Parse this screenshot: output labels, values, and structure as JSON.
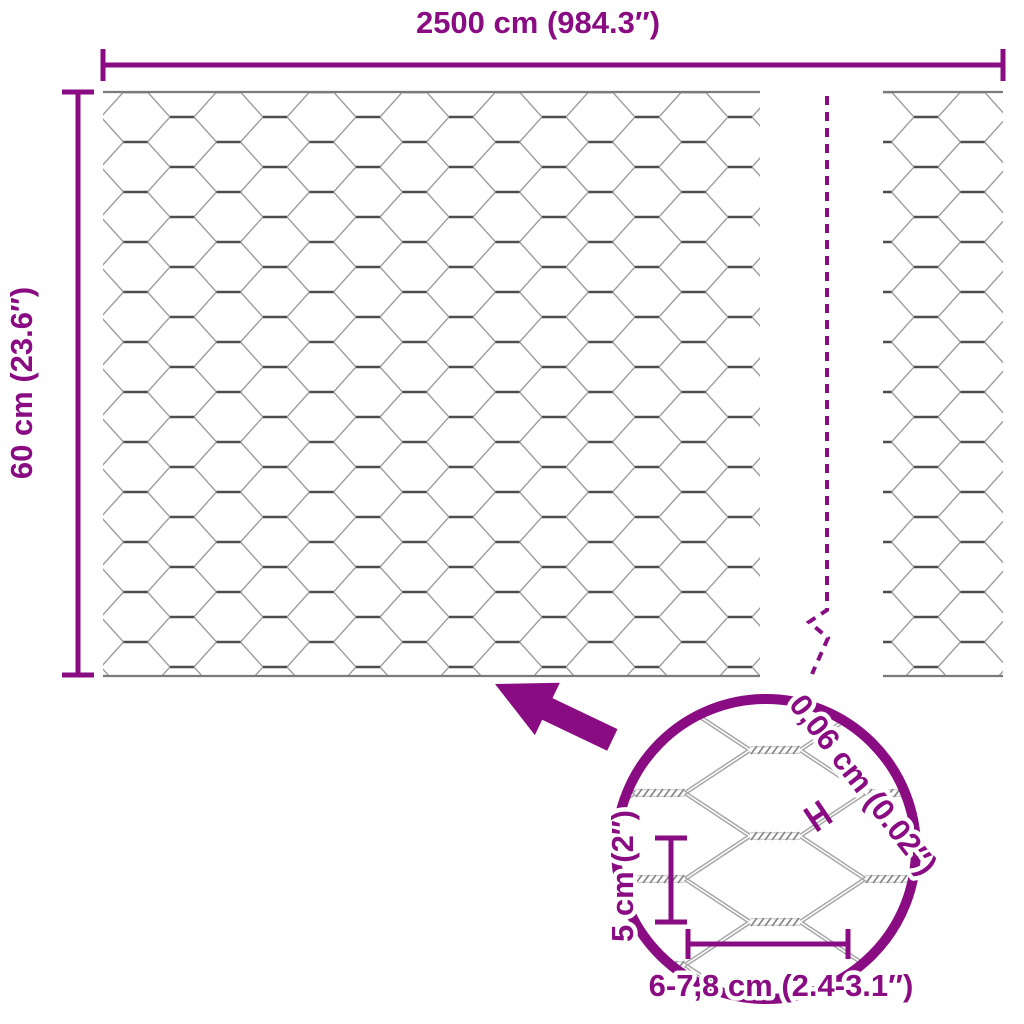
{
  "diagram": {
    "type": "product-dimension-diagram",
    "subject": "hexagonal-wire-mesh-roll",
    "width_label": "2500 cm (984.3″)",
    "height_label": "60 cm (23.6″)",
    "detail": {
      "wire_thickness_label": "0,06 cm (0.02″)",
      "mesh_height_label": "5 cm (2″)",
      "mesh_width_label": "6-7,8 cm (2.4-3.1″)"
    },
    "colors": {
      "accent": "#8A0C82",
      "wire": "#9C9C9C",
      "twist": "#4D4D4D",
      "selvage": "#7A7A7A"
    }
  }
}
